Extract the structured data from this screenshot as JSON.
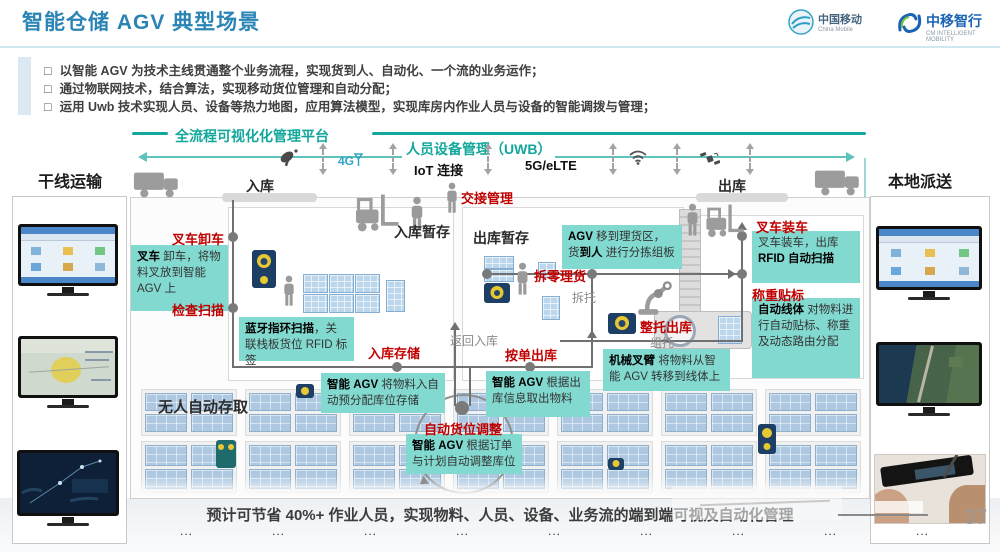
{
  "header": {
    "title": "智能仓储 AGV 典型场景",
    "cm_logo": {
      "name": "中国移动",
      "sub": "China Mobile"
    },
    "cmi_logo": {
      "name": "中移智行",
      "sub": "CM INTELLIGENT MOBILITY"
    }
  },
  "glyphs": {
    "checkbox": "□",
    "ellipsis": "..."
  },
  "bullets": [
    "以智能 AGV 为技术主线贯通整个业务流程，实现货到人、自动化、一个流的业务运作；",
    "通过物联网技术，结合算法，实现移动货位管理和自动分配；",
    "运用 Uwb 技术实现人员、设备等热力地图，应用算法模型，实现库房内作业人员与设备的智能调拨与管理；"
  ],
  "platform": {
    "title": "全流程可视化化管理平台",
    "uwb": "人员设备管理（UWB）",
    "g4": "4G",
    "iot": "IoT 连接",
    "net": "5G/eLTE"
  },
  "left_panel": {
    "title": "干线运输",
    "items": [
      "预约送货",
      "风险预警",
      "运输可视"
    ]
  },
  "right_panel": {
    "title": "本地派送",
    "items": [
      "预约派送",
      "在途跟踪",
      "电子签收"
    ],
    "page": "37"
  },
  "zones": {
    "inbound": "入库",
    "outbound": "出库",
    "inbound_stage": "入库暂存",
    "outbound_stage": "出库暂存",
    "auto_storage": "无人自动存取"
  },
  "red_labels": {
    "forklift_unload": "叉车卸车",
    "check_scan": "检查扫描",
    "in_store": "入库存储",
    "order_out": "按单出库",
    "auto_adjust": "自动货位调整",
    "split_pick": "拆零理货",
    "full_out": "整托出库",
    "load_truck": "叉车装车",
    "weigh_label": "称重贴标",
    "handover": "交接管理"
  },
  "gray_labels": {
    "return_in": "返回入库",
    "break_pallet": "拆托",
    "group_pallet": "组托"
  },
  "callouts": {
    "forklift_unload": {
      "bold": "叉车",
      "rest": " 卸车，将物料叉放到智能 AGV 上"
    },
    "bluetooth": {
      "bold": "蓝牙指环扫描",
      "rest": "，关联栈板货位 RFID 标签"
    },
    "agv_in": {
      "bold": "智能 AGV",
      "rest": " 将物料入自动预分配库位存储"
    },
    "agv_out": {
      "bold": "智能 AGV",
      "rest": " 根据出库信息取出物料"
    },
    "agv_adjust": {
      "bold": "智能 AGV",
      "rest": " 根据订单与计划自动调整库位"
    },
    "agv_pick": {
      "bold1": "AGV",
      "rest1": " 移到理货区，货",
      "bold2": "到人",
      "rest2": " 进行分拣组板"
    },
    "arm": {
      "bold": "机械叉臂",
      "rest": " 将物料从智能 AGV 转移到线体上"
    },
    "load": {
      "line1": "叉车装车，出库",
      "line2": "RFID 自动扫描"
    },
    "auto_line": {
      "bold": "自动线体",
      "rest": " 对物料进行自动贴标、称重及动态路由分配"
    }
  },
  "caption": "预计可节省 40%+ 作业人员，实现物料、人员、设备、业务流的端到端可视及自动化管理"
}
